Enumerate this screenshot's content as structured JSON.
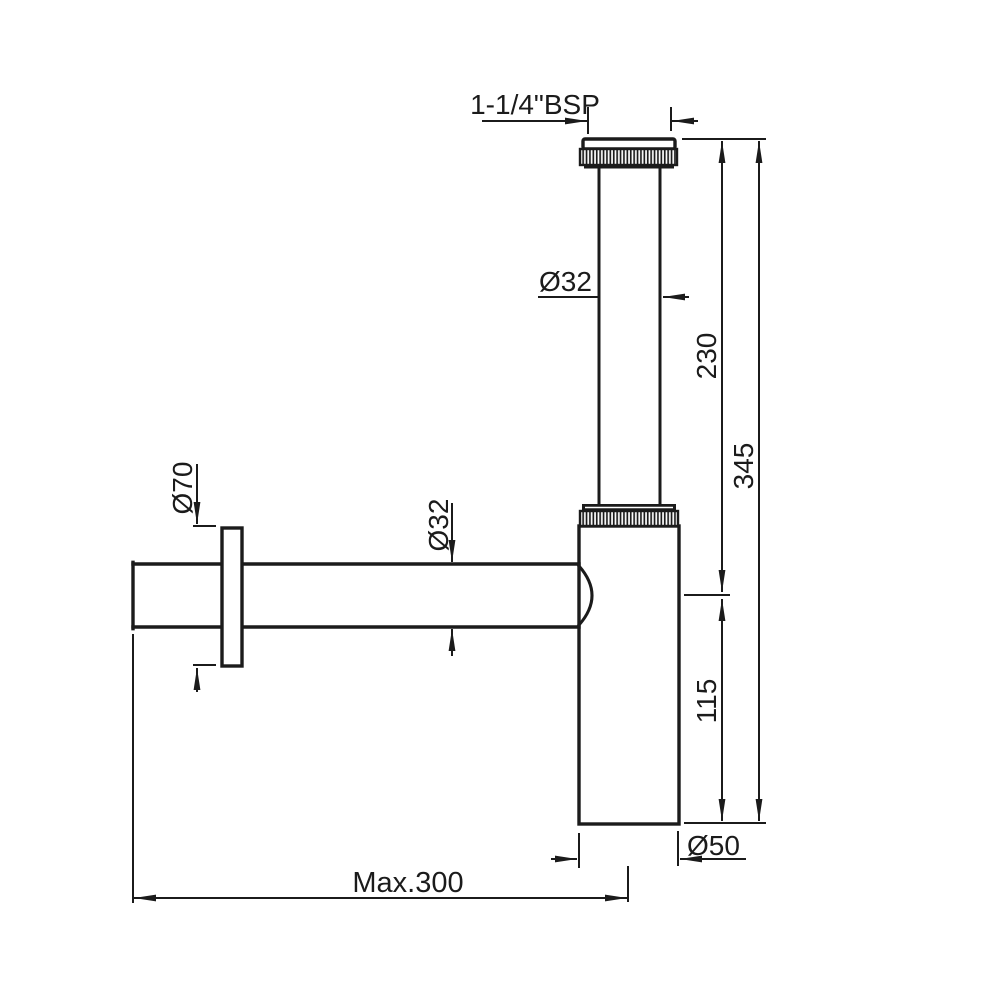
{
  "canvas": {
    "background": "#ffffff",
    "ink": "#1b1b1b"
  },
  "drawing": {
    "subject": "Bottle trap technical drawing, side elevation with dimensions",
    "units": "mm",
    "labels": {
      "thread_size": "1-1/4\"BSP",
      "tail_pipe_diameter": "Ø32",
      "tail_pipe_length": "230",
      "overall_height": "345",
      "flange_diameter": "Ø70",
      "waste_pipe_diameter": "Ø32",
      "body_height": "115",
      "body_diameter": "Ø50",
      "wall_distance_max": "Max.300"
    }
  }
}
